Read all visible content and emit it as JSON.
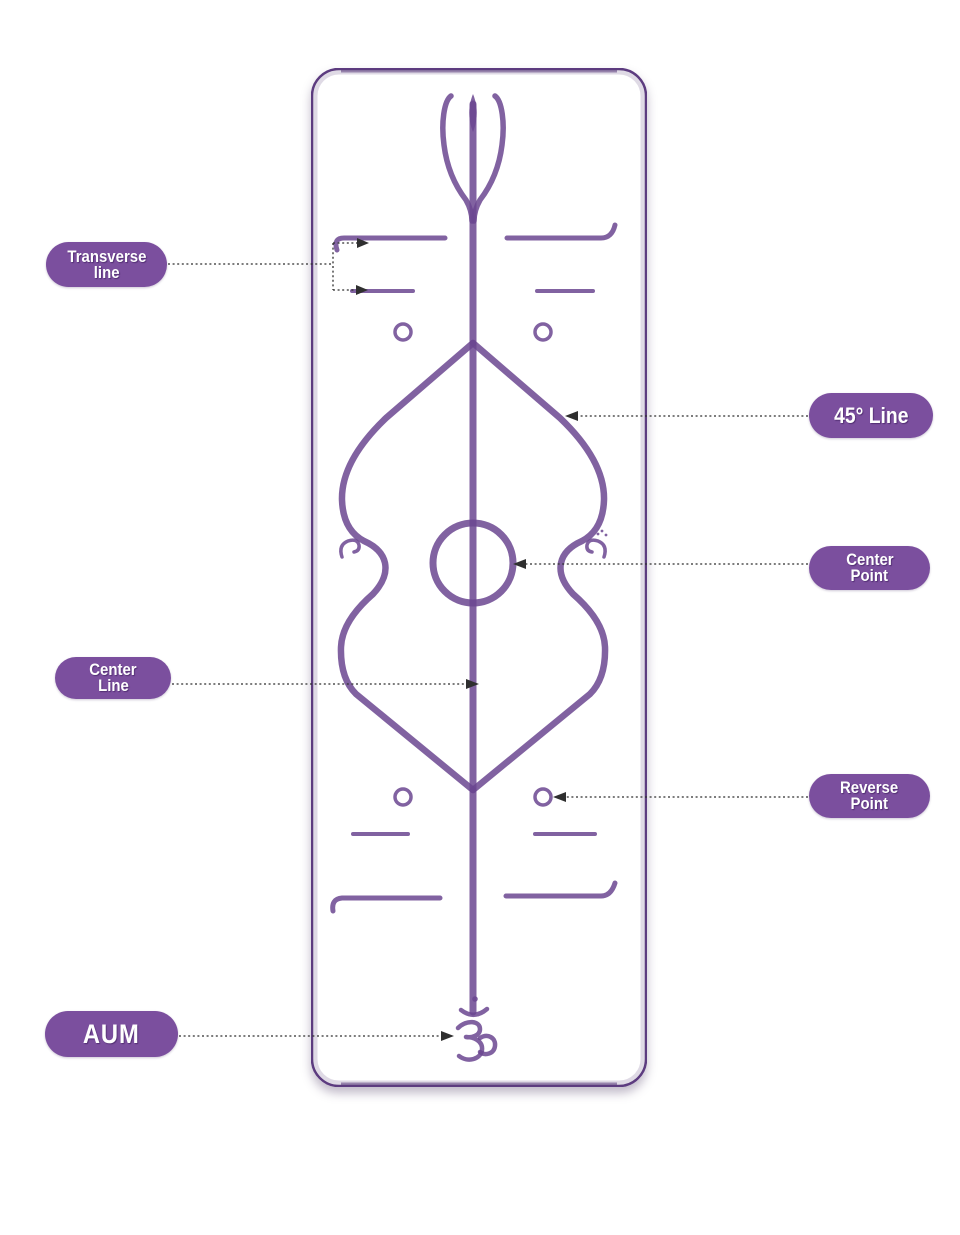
{
  "diagram": {
    "subject": "yoga-mat-alignment-guide",
    "colors": {
      "background": "#ffffff",
      "mat": "#8a63a8",
      "mat_texture_light": "#9d79b9",
      "mat_texture_dark": "#76519b",
      "mat_edge": "#5d3c80",
      "marking": "#6b4791",
      "label_bg": "#7b4f9e",
      "label_text": "#ffffff",
      "connector": "#2f2f2f"
    },
    "labels": [
      {
        "id": "transverse-line",
        "lines": [
          "Transverse",
          "line"
        ],
        "side": "left"
      },
      {
        "id": "45-line",
        "lines": [
          "45° Line"
        ],
        "side": "right"
      },
      {
        "id": "center-point",
        "lines": [
          "Center",
          "Point"
        ],
        "side": "right"
      },
      {
        "id": "center-line",
        "lines": [
          "Center",
          "Line"
        ],
        "side": "left"
      },
      {
        "id": "reverse-point",
        "lines": [
          "Reverse",
          "Point"
        ],
        "side": "right"
      },
      {
        "id": "aum",
        "lines": [
          "AUM"
        ],
        "side": "left"
      }
    ],
    "mat_features": [
      "trident-symbol",
      "transverse-lines",
      "45-degree-lines",
      "center-point-circle",
      "center-line",
      "reverse-point-circles",
      "swan-motifs",
      "aum-symbol"
    ]
  }
}
